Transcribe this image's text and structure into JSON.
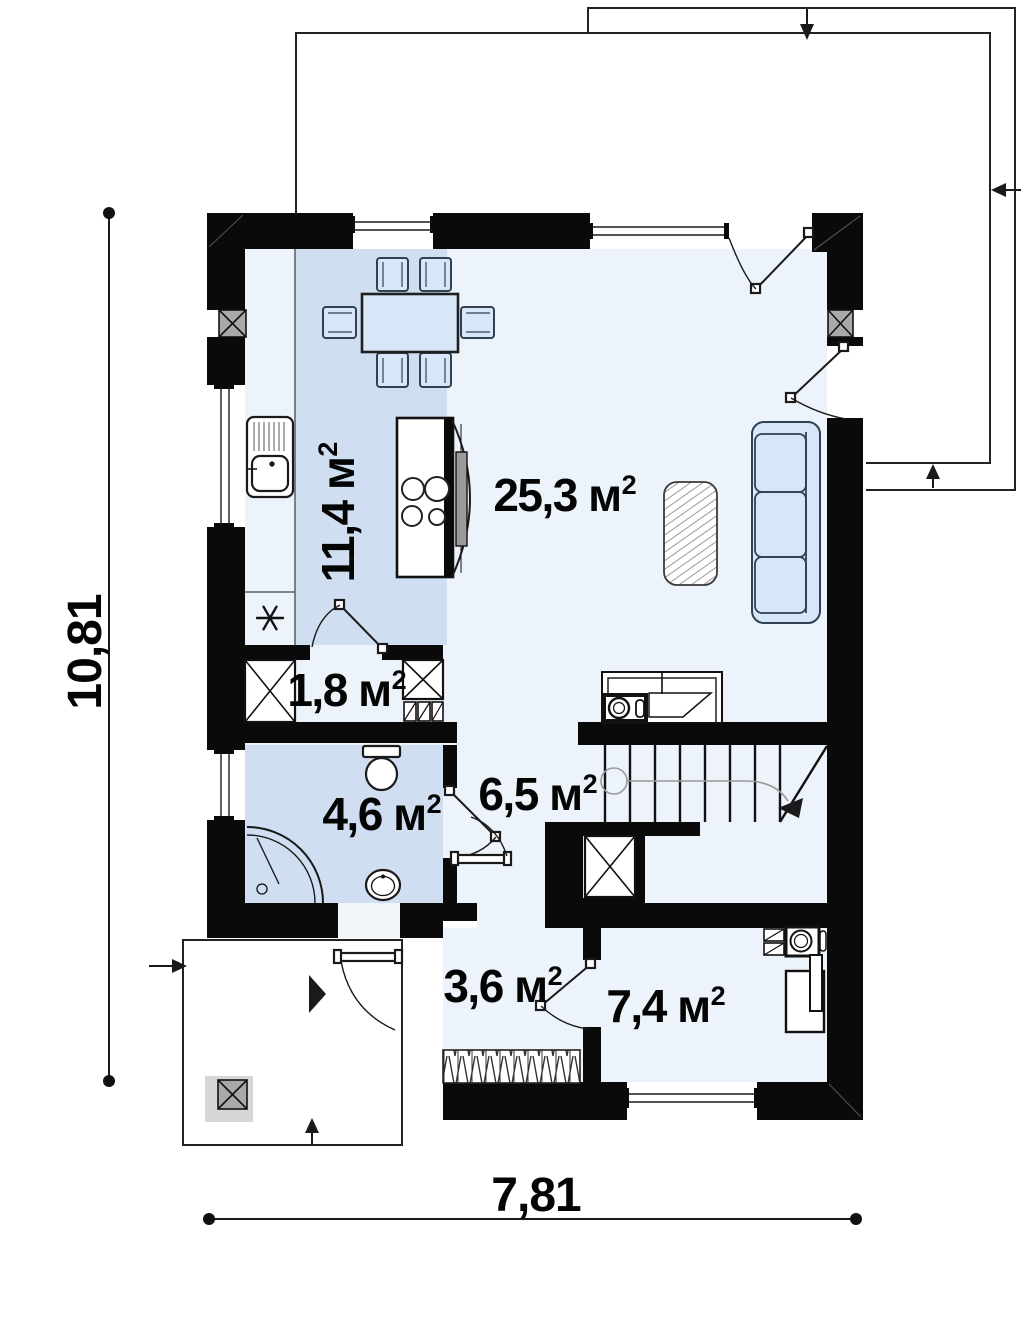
{
  "floor_plan": {
    "title": "first-floor plan",
    "rooms": [
      {
        "id": "kitchen",
        "label": "11,4 м",
        "sup": "2"
      },
      {
        "id": "living-room",
        "label": "25,3 м",
        "sup": "2"
      },
      {
        "id": "closet",
        "label": "1,8 м",
        "sup": "2"
      },
      {
        "id": "bathroom",
        "label": "4,6 м",
        "sup": "2"
      },
      {
        "id": "hall",
        "label": "6,5 м",
        "sup": "2"
      },
      {
        "id": "entry",
        "label": "3,6 м",
        "sup": "2"
      },
      {
        "id": "boiler-room",
        "label": "7,4 м",
        "sup": "2"
      }
    ],
    "dimensions": {
      "height_total": "10,81",
      "width_total": "7,81"
    },
    "colors": {
      "wall": "#0a0a0a",
      "wet_room_tint": "#cfdff1",
      "floor_tint": "#edf3fa",
      "furniture_fill": "#d7e7f7",
      "column_fill": "#a9a9a9"
    },
    "icons": {
      "snowflake": "fridge-position symbol",
      "x_box": "wardrobe / shaft symbol",
      "column_x": "structural column",
      "direction_arrows": "entry and terrace direction arrows"
    }
  }
}
